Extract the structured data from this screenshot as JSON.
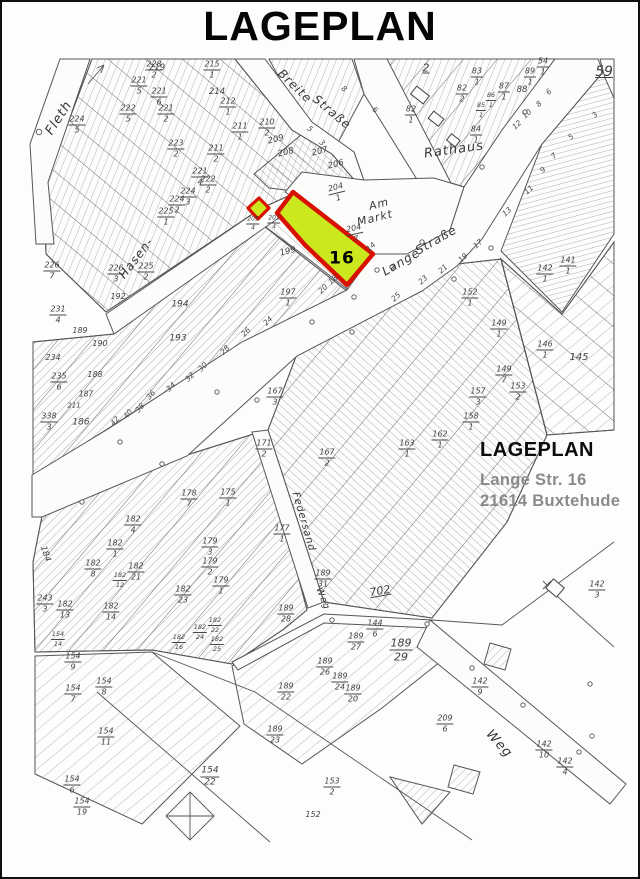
{
  "page": {
    "title": "LAGEPLAN"
  },
  "annotation": {
    "heading": "LAGEPLAN",
    "address_line1": "Lange Str. 16",
    "address_line2": "21614 Buxtehude"
  },
  "highlight": {
    "parcel_label": "16",
    "fill": "#cbe71d",
    "stroke": "#d81000"
  },
  "colors": {
    "ink": "#55555c",
    "hatch": "#9a9aa3",
    "paper": "#fcfcfa"
  },
  "map": {
    "labels": [
      {
        "t": "Fleth",
        "x": 57,
        "y": 116,
        "r": -57,
        "k": "street",
        "s": 13
      },
      {
        "t": "Breite",
        "x": 293,
        "y": 84,
        "r": 44,
        "k": "street",
        "s": 12
      },
      {
        "t": "Straße",
        "x": 330,
        "y": 110,
        "r": 40,
        "k": "street",
        "s": 12
      },
      {
        "t": "Rathaus",
        "x": 452,
        "y": 148,
        "r": -8,
        "k": "street",
        "s": 13
      },
      {
        "t": "Am",
        "x": 377,
        "y": 202,
        "r": -14,
        "k": "street",
        "s": 11
      },
      {
        "t": "Markt",
        "x": 373,
        "y": 216,
        "r": -14,
        "k": "street",
        "s": 11
      },
      {
        "t": "Lange",
        "x": 399,
        "y": 260,
        "r": -30,
        "k": "street",
        "s": 12
      },
      {
        "t": "Straße",
        "x": 434,
        "y": 238,
        "r": -30,
        "k": "street",
        "s": 12
      },
      {
        "t": "Hasen-",
        "x": 134,
        "y": 256,
        "r": -52,
        "k": "street",
        "s": 12
      },
      {
        "t": "Federsand",
        "x": 301,
        "y": 520,
        "r": 74,
        "k": "street",
        "s": 10
      },
      {
        "t": "Weg",
        "x": 497,
        "y": 742,
        "r": 48,
        "k": "street",
        "s": 13
      },
      {
        "t": "Weg",
        "x": 320,
        "y": 597,
        "r": 68,
        "k": "street",
        "s": 9
      },
      {
        "t": "16",
        "x": 340,
        "y": 257,
        "k": "bold",
        "s": 17
      },
      {
        "t": "59",
        "x": 602,
        "y": 70,
        "k": "plain",
        "s": 14,
        "u": true
      },
      {
        "t": "702",
        "x": 378,
        "y": 589,
        "r": -10,
        "k": "plain",
        "s": 11,
        "u": true
      },
      {
        "t": "2",
        "x": 424,
        "y": 66,
        "k": "plain",
        "s": 11,
        "u": true
      },
      {
        "t": "152",
        "x": 311,
        "y": 813,
        "k": "plain",
        "s": 8
      },
      {
        "t": "206",
        "x": 334,
        "y": 163,
        "r": -14,
        "k": "plain",
        "s": 8.5
      },
      {
        "t": "207",
        "x": 318,
        "y": 150,
        "r": -14,
        "k": "plain",
        "s": 8.5
      },
      {
        "t": "208",
        "x": 284,
        "y": 151,
        "r": -14,
        "k": "plain",
        "s": 8.5
      },
      {
        "t": "209",
        "x": 274,
        "y": 138,
        "r": -14,
        "k": "plain",
        "s": 8.5
      },
      {
        "t": "219",
        "x": 155,
        "y": 66,
        "k": "plain",
        "s": 8.5
      },
      {
        "t": "214",
        "x": 215,
        "y": 90,
        "k": "plain",
        "s": 8.5
      },
      {
        "t": "88",
        "x": 520,
        "y": 88,
        "k": "plain",
        "s": 8.5
      },
      {
        "t": "145",
        "x": 577,
        "y": 356,
        "k": "plain",
        "s": 10
      },
      {
        "t": "199",
        "x": 286,
        "y": 250,
        "r": -14,
        "k": "plain",
        "s": 8.5
      },
      {
        "t": "184",
        "x": 43,
        "y": 552,
        "r": 70,
        "k": "plain",
        "s": 8.5
      },
      {
        "t": "186",
        "x": 79,
        "y": 421,
        "k": "plain",
        "s": 9
      },
      {
        "t": "187",
        "x": 84,
        "y": 392,
        "k": "plain",
        "s": 7.5
      },
      {
        "t": "188",
        "x": 93,
        "y": 373,
        "k": "plain",
        "s": 8
      },
      {
        "t": "189",
        "x": 78,
        "y": 329,
        "k": "plain",
        "s": 8
      },
      {
        "t": "190",
        "x": 98,
        "y": 342,
        "k": "plain",
        "s": 8
      },
      {
        "t": "192",
        "x": 116,
        "y": 295,
        "k": "plain",
        "s": 8
      },
      {
        "t": "193",
        "x": 176,
        "y": 337,
        "k": "plain",
        "s": 9
      },
      {
        "t": "194",
        "x": 178,
        "y": 303,
        "k": "plain",
        "s": 9
      },
      {
        "t": "234",
        "x": 51,
        "y": 356,
        "k": "plain",
        "s": 8
      },
      {
        "t": "211",
        "x": 72,
        "y": 404,
        "k": "plain",
        "s": 7
      },
      {
        "t": "226/7",
        "x": 50,
        "y": 269,
        "k": "frac"
      },
      {
        "t": "224/5",
        "x": 75,
        "y": 123,
        "k": "frac"
      },
      {
        "t": "228/2",
        "x": 152,
        "y": 68,
        "k": "frac"
      },
      {
        "t": "215/1",
        "x": 210,
        "y": 68,
        "k": "frac"
      },
      {
        "t": "221/5",
        "x": 137,
        "y": 84,
        "k": "frac"
      },
      {
        "t": "221/6",
        "x": 157,
        "y": 95,
        "k": "frac"
      },
      {
        "t": "212/1",
        "x": 226,
        "y": 105,
        "k": "frac"
      },
      {
        "t": "222/5",
        "x": 126,
        "y": 112,
        "k": "frac"
      },
      {
        "t": "221/2",
        "x": 164,
        "y": 112,
        "k": "frac"
      },
      {
        "t": "211/1",
        "x": 238,
        "y": 130,
        "k": "frac"
      },
      {
        "t": "210/2",
        "x": 265,
        "y": 126,
        "k": "frac"
      },
      {
        "t": "223/2",
        "x": 174,
        "y": 147,
        "k": "frac"
      },
      {
        "t": "211/2",
        "x": 214,
        "y": 152,
        "k": "frac"
      },
      {
        "t": "221/4",
        "x": 198,
        "y": 175,
        "k": "frac"
      },
      {
        "t": "222/2",
        "x": 206,
        "y": 183,
        "k": "frac"
      },
      {
        "t": "224/3",
        "x": 186,
        "y": 195,
        "k": "frac"
      },
      {
        "t": "224/2",
        "x": 175,
        "y": 203,
        "k": "frac"
      },
      {
        "t": "225/1",
        "x": 164,
        "y": 215,
        "k": "frac"
      },
      {
        "t": "226/3",
        "x": 114,
        "y": 272,
        "k": "frac"
      },
      {
        "t": "225/2",
        "x": 144,
        "y": 270,
        "k": "frac"
      },
      {
        "t": "231/4",
        "x": 56,
        "y": 313,
        "k": "frac"
      },
      {
        "t": "235/6",
        "x": 57,
        "y": 380,
        "k": "frac"
      },
      {
        "t": "338/3",
        "x": 47,
        "y": 420,
        "k": "frac"
      },
      {
        "t": "83/1",
        "x": 475,
        "y": 75,
        "k": "frac"
      },
      {
        "t": "82/2",
        "x": 460,
        "y": 92,
        "k": "frac"
      },
      {
        "t": "82/1",
        "x": 409,
        "y": 113,
        "k": "frac"
      },
      {
        "t": "85/1",
        "x": 479,
        "y": 108,
        "k": "frac",
        "s": 6.5
      },
      {
        "t": "86/1",
        "x": 489,
        "y": 98,
        "k": "frac",
        "s": 6.5
      },
      {
        "t": "87/1",
        "x": 502,
        "y": 90,
        "k": "frac"
      },
      {
        "t": "89/1",
        "x": 528,
        "y": 75,
        "k": "frac"
      },
      {
        "t": "54/1",
        "x": 541,
        "y": 65,
        "k": "frac"
      },
      {
        "t": "84/1",
        "x": 474,
        "y": 133,
        "k": "frac"
      },
      {
        "t": "204/1",
        "x": 335,
        "y": 191,
        "r": -14,
        "k": "frac"
      },
      {
        "t": "204/7",
        "x": 353,
        "y": 232,
        "r": -12,
        "k": "frac"
      },
      {
        "t": "205/4",
        "x": 251,
        "y": 222,
        "k": "frac",
        "s": 6
      },
      {
        "t": "201/4",
        "x": 272,
        "y": 221,
        "k": "frac",
        "s": 6
      },
      {
        "t": "197/1",
        "x": 286,
        "y": 296,
        "k": "frac"
      },
      {
        "t": "152/1",
        "x": 468,
        "y": 296,
        "k": "frac"
      },
      {
        "t": "142/1",
        "x": 543,
        "y": 272,
        "k": "frac"
      },
      {
        "t": "141/1",
        "x": 566,
        "y": 264,
        "k": "frac"
      },
      {
        "t": "149/1",
        "x": 497,
        "y": 327,
        "k": "frac"
      },
      {
        "t": "146/1",
        "x": 543,
        "y": 348,
        "k": "frac"
      },
      {
        "t": "149/7",
        "x": 502,
        "y": 373,
        "k": "frac"
      },
      {
        "t": "153/2",
        "x": 516,
        "y": 390,
        "k": "frac"
      },
      {
        "t": "157/3",
        "x": 476,
        "y": 395,
        "k": "frac"
      },
      {
        "t": "158/1",
        "x": 469,
        "y": 420,
        "k": "frac"
      },
      {
        "t": "162/1",
        "x": 438,
        "y": 438,
        "k": "frac"
      },
      {
        "t": "163/1",
        "x": 405,
        "y": 447,
        "k": "frac"
      },
      {
        "t": "167/3",
        "x": 273,
        "y": 395,
        "k": "frac"
      },
      {
        "t": "167/2",
        "x": 325,
        "y": 456,
        "k": "frac"
      },
      {
        "t": "171/2",
        "x": 262,
        "y": 447,
        "k": "frac"
      },
      {
        "t": "177/1",
        "x": 280,
        "y": 532,
        "k": "frac"
      },
      {
        "t": "178/7",
        "x": 187,
        "y": 497,
        "k": "frac"
      },
      {
        "t": "175/1",
        "x": 226,
        "y": 496,
        "k": "frac"
      },
      {
        "t": "179/3",
        "x": 208,
        "y": 545,
        "k": "frac"
      },
      {
        "t": "179/2",
        "x": 208,
        "y": 565,
        "k": "frac"
      },
      {
        "t": "179/1",
        "x": 219,
        "y": 584,
        "k": "frac"
      },
      {
        "t": "182/4",
        "x": 131,
        "y": 523,
        "k": "frac"
      },
      {
        "t": "182/1",
        "x": 113,
        "y": 547,
        "k": "frac"
      },
      {
        "t": "182/8",
        "x": 91,
        "y": 567,
        "k": "frac"
      },
      {
        "t": "182/21",
        "x": 134,
        "y": 570,
        "k": "frac"
      },
      {
        "t": "182/12",
        "x": 118,
        "y": 578,
        "k": "frac",
        "s": 6.5
      },
      {
        "t": "182/13",
        "x": 63,
        "y": 608,
        "k": "frac"
      },
      {
        "t": "182/14",
        "x": 109,
        "y": 610,
        "k": "frac"
      },
      {
        "t": "182/23",
        "x": 181,
        "y": 593,
        "k": "frac"
      },
      {
        "t": "243/3",
        "x": 43,
        "y": 602,
        "k": "frac"
      },
      {
        "t": "154/14",
        "x": 56,
        "y": 637,
        "k": "frac",
        "s": 6.5
      },
      {
        "t": "182/22",
        "x": 213,
        "y": 623,
        "k": "frac",
        "s": 6.5
      },
      {
        "t": "182/24",
        "x": 198,
        "y": 630,
        "k": "frac",
        "s": 6.5
      },
      {
        "t": "182/25",
        "x": 215,
        "y": 642,
        "k": "frac",
        "s": 6.5
      },
      {
        "t": "182/16",
        "x": 177,
        "y": 640,
        "k": "frac",
        "s": 6.5
      },
      {
        "t": "189/31",
        "x": 321,
        "y": 577,
        "k": "frac"
      },
      {
        "t": "189/28",
        "x": 284,
        "y": 612,
        "k": "frac"
      },
      {
        "t": "144/6",
        "x": 373,
        "y": 627,
        "k": "frac"
      },
      {
        "t": "189/27",
        "x": 354,
        "y": 640,
        "k": "frac"
      },
      {
        "t": "189/29",
        "x": 399,
        "y": 648,
        "k": "frac",
        "s": 11
      },
      {
        "t": "189/26",
        "x": 323,
        "y": 665,
        "k": "frac"
      },
      {
        "t": "189/24",
        "x": 338,
        "y": 680,
        "k": "frac"
      },
      {
        "t": "189/20",
        "x": 351,
        "y": 692,
        "k": "frac"
      },
      {
        "t": "189/22",
        "x": 284,
        "y": 690,
        "k": "frac"
      },
      {
        "t": "142/9",
        "x": 478,
        "y": 685,
        "k": "frac"
      },
      {
        "t": "209/6",
        "x": 443,
        "y": 722,
        "k": "frac"
      },
      {
        "t": "142/10",
        "x": 542,
        "y": 748,
        "k": "frac"
      },
      {
        "t": "142/4",
        "x": 563,
        "y": 765,
        "k": "frac"
      },
      {
        "t": "142/3",
        "x": 595,
        "y": 588,
        "k": "frac"
      },
      {
        "t": "154/9",
        "x": 71,
        "y": 660,
        "k": "frac"
      },
      {
        "t": "154/8",
        "x": 102,
        "y": 685,
        "k": "frac"
      },
      {
        "t": "154/7",
        "x": 71,
        "y": 692,
        "k": "frac"
      },
      {
        "t": "154/11",
        "x": 104,
        "y": 735,
        "k": "frac"
      },
      {
        "t": "154/6",
        "x": 70,
        "y": 783,
        "k": "frac"
      },
      {
        "t": "154/19",
        "x": 80,
        "y": 805,
        "k": "frac"
      },
      {
        "t": "154/22",
        "x": 208,
        "y": 775,
        "k": "frac",
        "s": 9
      },
      {
        "t": "189/23",
        "x": 273,
        "y": 733,
        "k": "frac"
      },
      {
        "t": "153/2",
        "x": 330,
        "y": 785,
        "k": "frac"
      },
      {
        "t": "42",
        "x": 113,
        "y": 419,
        "r": -50,
        "k": "house"
      },
      {
        "t": "40",
        "x": 126,
        "y": 412,
        "r": -50,
        "k": "house"
      },
      {
        "t": "38",
        "x": 138,
        "y": 406,
        "r": -50,
        "k": "house"
      },
      {
        "t": "36",
        "x": 149,
        "y": 393,
        "r": -50,
        "k": "house"
      },
      {
        "t": "34",
        "x": 169,
        "y": 385,
        "r": -46,
        "k": "house"
      },
      {
        "t": "32",
        "x": 188,
        "y": 375,
        "r": -46,
        "k": "house"
      },
      {
        "t": "30",
        "x": 201,
        "y": 365,
        "r": -46,
        "k": "house"
      },
      {
        "t": "28",
        "x": 223,
        "y": 348,
        "r": -46,
        "k": "house"
      },
      {
        "t": "26",
        "x": 244,
        "y": 330,
        "r": -46,
        "k": "house"
      },
      {
        "t": "24",
        "x": 266,
        "y": 319,
        "r": -46,
        "k": "house"
      },
      {
        "t": "20",
        "x": 321,
        "y": 287,
        "r": -42,
        "k": "house"
      },
      {
        "t": "18",
        "x": 331,
        "y": 278,
        "r": -42,
        "k": "house"
      },
      {
        "t": "14",
        "x": 369,
        "y": 245,
        "r": -42,
        "k": "house"
      },
      {
        "t": "25",
        "x": 394,
        "y": 295,
        "r": -42,
        "k": "house"
      },
      {
        "t": "23",
        "x": 421,
        "y": 278,
        "r": -42,
        "k": "house"
      },
      {
        "t": "21",
        "x": 441,
        "y": 267,
        "r": -42,
        "k": "house"
      },
      {
        "t": "19",
        "x": 461,
        "y": 256,
        "r": -42,
        "k": "house"
      },
      {
        "t": "17",
        "x": 476,
        "y": 242,
        "r": -42,
        "k": "house"
      },
      {
        "t": "13",
        "x": 505,
        "y": 210,
        "r": -42,
        "k": "house"
      },
      {
        "t": "11",
        "x": 527,
        "y": 188,
        "r": -42,
        "k": "house"
      },
      {
        "t": "9",
        "x": 541,
        "y": 168,
        "r": -42,
        "k": "house"
      },
      {
        "t": "7",
        "x": 552,
        "y": 154,
        "r": -42,
        "k": "house"
      },
      {
        "t": "5",
        "x": 569,
        "y": 135,
        "r": -42,
        "k": "house"
      },
      {
        "t": "3",
        "x": 593,
        "y": 113,
        "r": -42,
        "k": "house"
      },
      {
        "t": "12",
        "x": 515,
        "y": 123,
        "r": -42,
        "k": "house"
      },
      {
        "t": "10",
        "x": 525,
        "y": 112,
        "r": -42,
        "k": "house"
      },
      {
        "t": "8",
        "x": 537,
        "y": 102,
        "r": -42,
        "k": "house"
      },
      {
        "t": "6",
        "x": 547,
        "y": 90,
        "r": -42,
        "k": "house"
      },
      {
        "t": "5",
        "x": 308,
        "y": 127,
        "r": 40,
        "k": "house"
      },
      {
        "t": "3",
        "x": 320,
        "y": 141,
        "r": 40,
        "k": "house"
      },
      {
        "t": "8",
        "x": 342,
        "y": 87,
        "r": 40,
        "k": "house"
      },
      {
        "t": "6",
        "x": 373,
        "y": 108,
        "r": 40,
        "k": "house"
      }
    ]
  }
}
